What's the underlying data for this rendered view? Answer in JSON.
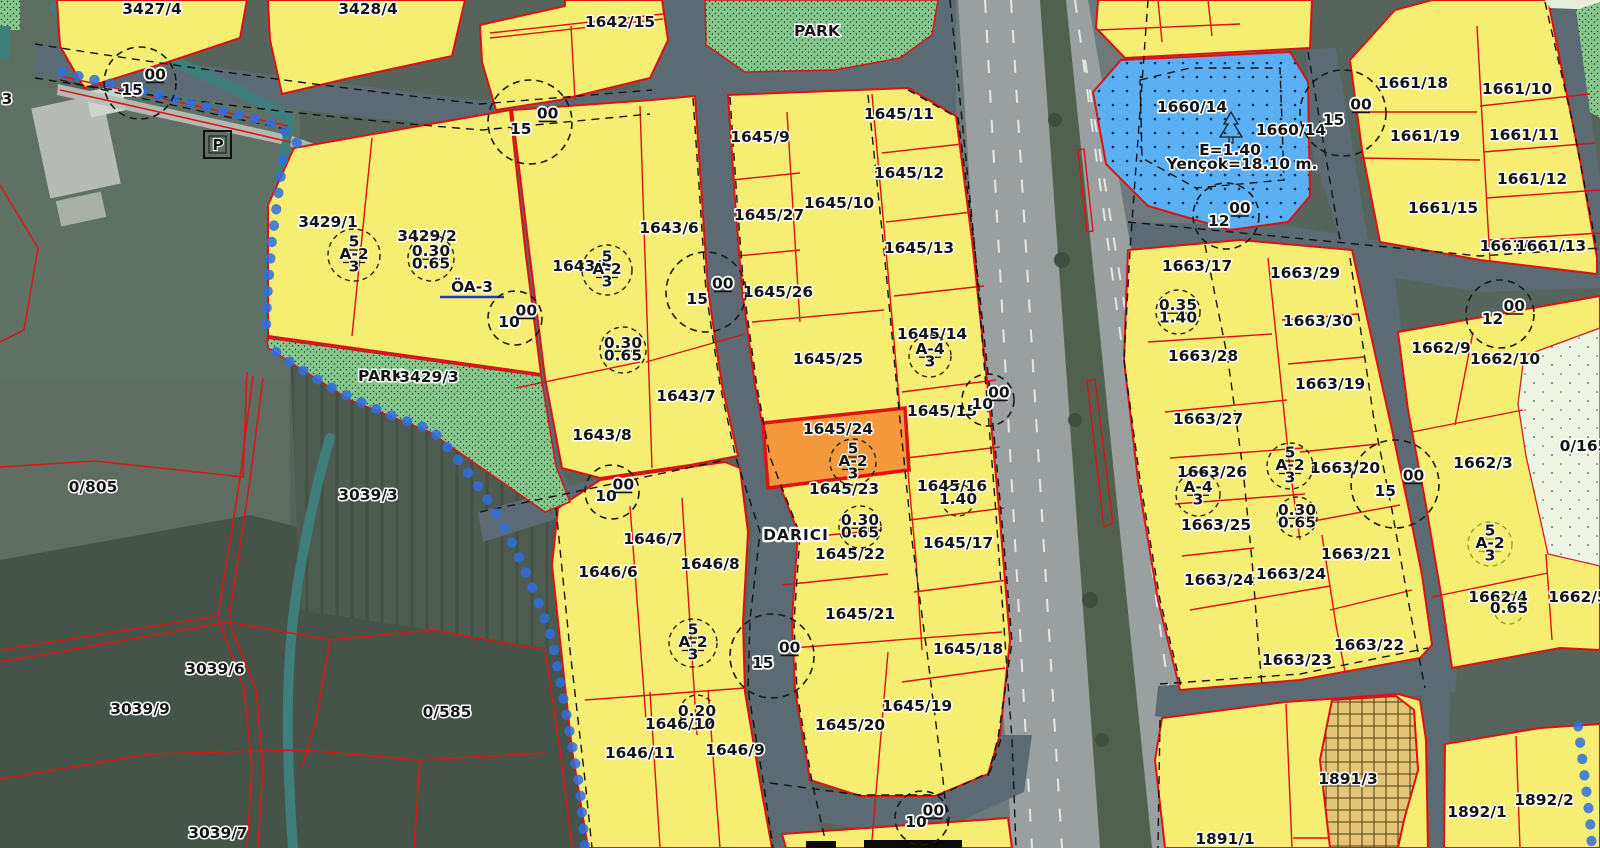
{
  "app": {
    "type": "cadastral-zoning-map-viewer",
    "place_name": "DARICI",
    "selected_parcel": "1645/24"
  },
  "map": {
    "colors": {
      "parcel_yellow": "#f6ee72",
      "selected_orange": "#f59a3c",
      "selected_border": "#e01212",
      "selected_label": "#c4374b",
      "boundary_red": "#dc1212",
      "park_green": "#85c78c",
      "social_facility_blue": "#5bb0f4",
      "oa_blue": "#2433cc",
      "water_teal": "#3e7f7b",
      "stream_chain_blue": "#2f6fe0",
      "road_gray": "#5c6b73",
      "highway_gray": "#9aa09f",
      "olive_zone": "#9aa520"
    },
    "parcel_labels": [
      {
        "text": "3",
        "x": 7,
        "y": 104
      },
      {
        "text": "3427/4",
        "x": 152,
        "y": 14
      },
      {
        "text": "3428/4",
        "x": 368,
        "y": 14
      },
      {
        "text": "P",
        "x": 218,
        "y": 150,
        "kind": "box"
      },
      {
        "text": "0/805",
        "x": 93,
        "y": 492
      },
      {
        "text": "3039/3",
        "x": 368,
        "y": 500
      },
      {
        "text": "3039/6",
        "x": 215,
        "y": 674
      },
      {
        "text": "3039/9",
        "x": 140,
        "y": 714
      },
      {
        "text": "3039/7",
        "x": 218,
        "y": 838
      },
      {
        "text": "0/585",
        "x": 447,
        "y": 717
      },
      {
        "text": "3429/1",
        "x": 328,
        "y": 227
      },
      {
        "text": "3429/2",
        "x": 427,
        "y": 241
      },
      {
        "text": "ÖA-3",
        "x": 472,
        "y": 292,
        "kind": "blue"
      },
      {
        "text": "PARK",
        "x": 381,
        "y": 381,
        "kind": "small"
      },
      {
        "text": "3429/3",
        "x": 429,
        "y": 382
      },
      {
        "text": "1642/15",
        "x": 620,
        "y": 27
      },
      {
        "text": "PARK",
        "x": 817,
        "y": 36,
        "kind": "small"
      },
      {
        "text": "1643/6",
        "x": 669,
        "y": 233
      },
      {
        "text": "1643/5",
        "x": 582,
        "y": 271
      },
      {
        "text": "1643/7",
        "x": 686,
        "y": 401
      },
      {
        "text": "1643/8",
        "x": 602,
        "y": 440
      },
      {
        "text": "1646/7",
        "x": 653,
        "y": 544
      },
      {
        "text": "1646/6",
        "x": 608,
        "y": 577
      },
      {
        "text": "1646/8",
        "x": 710,
        "y": 569
      },
      {
        "text": "1646/10",
        "x": 680,
        "y": 729
      },
      {
        "text": "1646/11",
        "x": 640,
        "y": 758
      },
      {
        "text": "1646/9",
        "x": 735,
        "y": 755
      },
      {
        "text": "1645/9",
        "x": 760,
        "y": 142
      },
      {
        "text": "1645/11",
        "x": 899,
        "y": 119
      },
      {
        "text": "1645/27",
        "x": 769,
        "y": 220
      },
      {
        "text": "1645/10",
        "x": 839,
        "y": 208
      },
      {
        "text": "1645/12",
        "x": 909,
        "y": 178
      },
      {
        "text": "1645/13",
        "x": 919,
        "y": 253
      },
      {
        "text": "1645/26",
        "x": 778,
        "y": 297
      },
      {
        "text": "1645/25",
        "x": 828,
        "y": 364
      },
      {
        "text": "1645/14",
        "x": 932,
        "y": 339
      },
      {
        "text": "1645/15",
        "x": 942,
        "y": 416
      },
      {
        "text": "1645/24",
        "x": 838,
        "y": 434,
        "kind": "sel"
      },
      {
        "text": "1645/23",
        "x": 844,
        "y": 494
      },
      {
        "text": "1645/16",
        "x": 952,
        "y": 491
      },
      {
        "text": "1645/22",
        "x": 850,
        "y": 559
      },
      {
        "text": "1645/17",
        "x": 958,
        "y": 548
      },
      {
        "text": "1645/21",
        "x": 860,
        "y": 619
      },
      {
        "text": "1645/18",
        "x": 968,
        "y": 654
      },
      {
        "text": "1645/19",
        "x": 917,
        "y": 711
      },
      {
        "text": "1645/20",
        "x": 850,
        "y": 730
      },
      {
        "text": "DARICI",
        "x": 796,
        "y": 540,
        "kind": "place"
      },
      {
        "text": "1660/14",
        "x": 1192,
        "y": 112
      },
      {
        "text": "1660/14",
        "x": 1291,
        "y": 135
      },
      {
        "text": "E=1.40",
        "x": 1230,
        "y": 155,
        "kind": "annot"
      },
      {
        "text": "Yençok=18.10 m.",
        "x": 1242,
        "y": 169,
        "kind": "annot"
      },
      {
        "text": "1661/18",
        "x": 1413,
        "y": 88
      },
      {
        "text": "1661/10",
        "x": 1517,
        "y": 94
      },
      {
        "text": "1661/19",
        "x": 1425,
        "y": 141
      },
      {
        "text": "1661/11",
        "x": 1524,
        "y": 140
      },
      {
        "text": "1661/12",
        "x": 1532,
        "y": 184
      },
      {
        "text": "1661/15",
        "x": 1443,
        "y": 213
      },
      {
        "text": "1661/",
        "x": 1504,
        "y": 251
      },
      {
        "text": "1661/13",
        "x": 1551,
        "y": 251
      },
      {
        "text": "1663/17",
        "x": 1197,
        "y": 271
      },
      {
        "text": "1663/29",
        "x": 1305,
        "y": 278
      },
      {
        "text": "1663/30",
        "x": 1318,
        "y": 326
      },
      {
        "text": "1663/28",
        "x": 1203,
        "y": 361
      },
      {
        "text": "1663/19",
        "x": 1330,
        "y": 389
      },
      {
        "text": "1663/27",
        "x": 1208,
        "y": 424
      },
      {
        "text": "1663/26",
        "x": 1212,
        "y": 477
      },
      {
        "text": "1663/20",
        "x": 1345,
        "y": 473
      },
      {
        "text": "1663/25",
        "x": 1216,
        "y": 530
      },
      {
        "text": "1663/21",
        "x": 1356,
        "y": 559
      },
      {
        "text": "1663/24",
        "x": 1219,
        "y": 585
      },
      {
        "text": "1663/24",
        "x": 1291,
        "y": 579
      },
      {
        "text": "1663/22",
        "x": 1369,
        "y": 650
      },
      {
        "text": "1663/23",
        "x": 1297,
        "y": 665
      },
      {
        "text": "1662/9",
        "x": 1441,
        "y": 353
      },
      {
        "text": "1662/10",
        "x": 1505,
        "y": 364
      },
      {
        "text": "1662/3",
        "x": 1483,
        "y": 468
      },
      {
        "text": "0/165",
        "x": 1584,
        "y": 451
      },
      {
        "text": "1662/4",
        "x": 1498,
        "y": 602
      },
      {
        "text": "1662/5",
        "x": 1578,
        "y": 602
      },
      {
        "text": "1891/3",
        "x": 1348,
        "y": 784
      },
      {
        "text": "1891/1",
        "x": 1225,
        "y": 844
      },
      {
        "text": "1892/1",
        "x": 1477,
        "y": 817
      },
      {
        "text": "1892/2",
        "x": 1544,
        "y": 805
      }
    ],
    "road_width_circles": [
      {
        "value": "15",
        "sup": "00",
        "x": 140,
        "y": 83,
        "r": 36
      },
      {
        "value": "15",
        "sup": "00",
        "x": 530,
        "y": 122,
        "r": 42
      },
      {
        "value": "15",
        "sup": "00",
        "x": 706,
        "y": 292,
        "r": 40
      },
      {
        "value": "10",
        "sup": "00",
        "x": 515,
        "y": 318,
        "r": 27
      },
      {
        "value": "10",
        "sup": "00",
        "x": 612,
        "y": 492,
        "r": 27
      },
      {
        "value": "15",
        "sup": "00",
        "x": 772,
        "y": 656,
        "r": 42
      },
      {
        "value": "10",
        "sup": "00",
        "x": 988,
        "y": 400,
        "r": 26
      },
      {
        "value": "10",
        "sup": "00",
        "x": 922,
        "y": 818,
        "r": 27
      },
      {
        "value": "15",
        "sup": "00",
        "x": 1343,
        "y": 113,
        "r": 43
      },
      {
        "value": "12",
        "sup": "00",
        "x": 1226,
        "y": 216,
        "r": 33
      },
      {
        "value": "12",
        "sup": "00",
        "x": 1500,
        "y": 314,
        "r": 34
      },
      {
        "value": "15",
        "sup": "00",
        "x": 1395,
        "y": 484,
        "r": 44
      }
    ],
    "zoning_circles": [
      {
        "lines": [
          "5",
          "A-2",
          "3"
        ],
        "x": 354,
        "y": 255,
        "r": 26
      },
      {
        "lines": [
          "0.30",
          "0.65"
        ],
        "x": 431,
        "y": 258,
        "r": 23
      },
      {
        "lines": [
          "5",
          "A-2",
          "3"
        ],
        "x": 607,
        "y": 270,
        "r": 25
      },
      {
        "lines": [
          "0.30",
          "0.65"
        ],
        "x": 623,
        "y": 350,
        "r": 23
      },
      {
        "lines": [
          "A-4",
          "3"
        ],
        "x": 930,
        "y": 356,
        "r": 21
      },
      {
        "lines": [
          "5",
          "A-2",
          "3"
        ],
        "x": 853,
        "y": 462,
        "r": 23
      },
      {
        "lines": [
          "1.40"
        ],
        "x": 958,
        "y": 500,
        "r": 16
      },
      {
        "lines": [
          "0.30",
          "0.65"
        ],
        "x": 860,
        "y": 527,
        "r": 21
      },
      {
        "lines": [
          "5",
          "A-2",
          "3"
        ],
        "x": 693,
        "y": 643,
        "r": 24
      },
      {
        "lines": [
          "0.20"
        ],
        "x": 697,
        "y": 712,
        "r": 17
      },
      {
        "lines": [
          "0.35",
          "1.40"
        ],
        "x": 1178,
        "y": 312,
        "r": 22
      },
      {
        "lines": [
          "5",
          "A-2",
          "3"
        ],
        "x": 1290,
        "y": 466,
        "r": 23
      },
      {
        "lines": [
          "A-4",
          "3"
        ],
        "x": 1198,
        "y": 494,
        "r": 22
      },
      {
        "lines": [
          "0.30",
          "0.65"
        ],
        "x": 1297,
        "y": 517,
        "r": 20
      },
      {
        "lines": [
          "5",
          "A-2",
          "3"
        ],
        "x": 1490,
        "y": 544,
        "r": 22,
        "color": "#9aa520"
      },
      {
        "lines": [
          "0.65"
        ],
        "x": 1509,
        "y": 609,
        "r": 15,
        "color": "#9aa520"
      }
    ]
  }
}
